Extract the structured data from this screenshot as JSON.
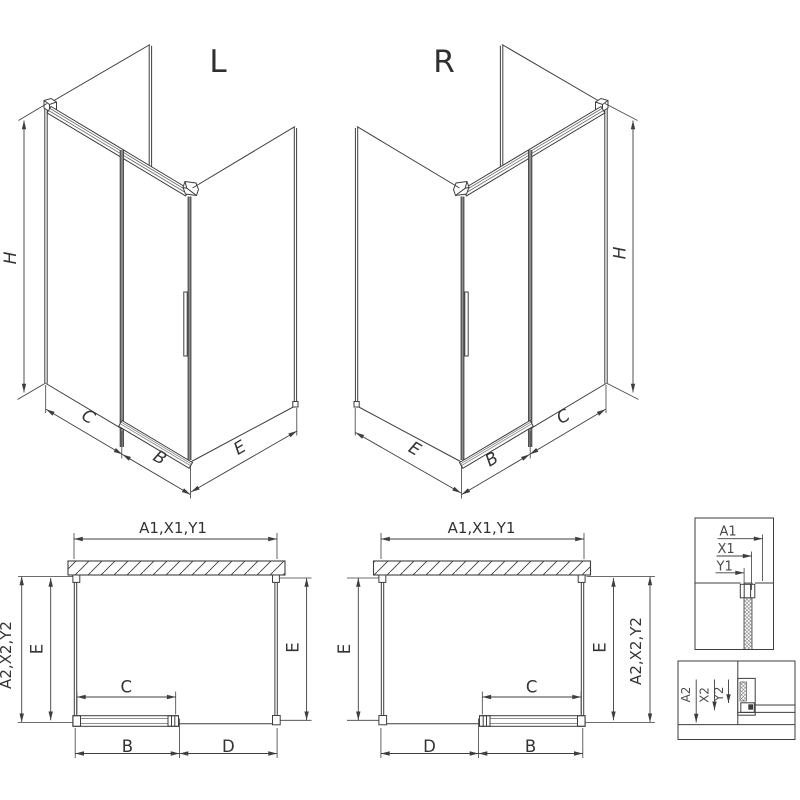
{
  "view_labels": {
    "left": "L",
    "right": "R"
  },
  "iso_dims": {
    "height": "H",
    "fixed_width": "C",
    "door_width": "B",
    "side_depth": "E"
  },
  "plan_dims": {
    "top_width": "A1,X1,Y1",
    "side_depth_full": "A2,X2,Y2",
    "side_depth": "E",
    "fixed_width": "C",
    "door_width": "B",
    "opening_width": "D"
  },
  "detail_top": {
    "a1": "A1",
    "x1": "X1",
    "y1": "Y1"
  },
  "detail_bottom": {
    "a2": "A2",
    "x2": "X2",
    "y2": "Y2"
  },
  "colors": {
    "line": "#3e3e3e",
    "profile_gray": "#8d8d8d",
    "background": "#ffffff"
  }
}
